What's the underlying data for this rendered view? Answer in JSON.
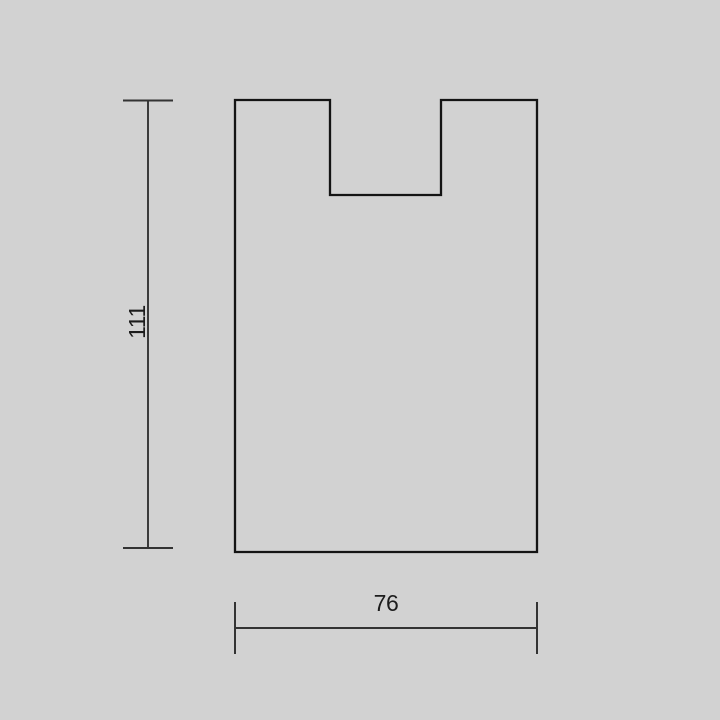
{
  "page": {
    "background_color": "#d2d2d2"
  },
  "drawing": {
    "type": "technical-dimension-drawing",
    "shape": "rectangle-outline-with-top-center-notch",
    "outline_color": "#141414",
    "dimension_line_color": "#333333",
    "text_color": "#1c1c1c",
    "dimensions": {
      "height": {
        "label": "111",
        "orientation": "vertical"
      },
      "width": {
        "label": "76",
        "orientation": "horizontal"
      }
    }
  }
}
